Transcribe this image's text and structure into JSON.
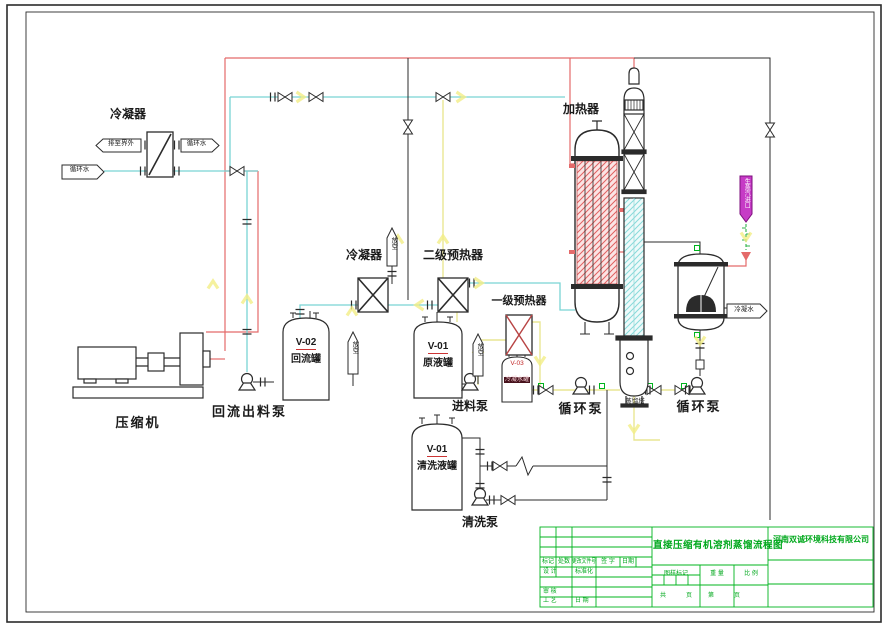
{
  "sheet": {
    "colors": {
      "line_black": "#2b2b2b",
      "pipe_red": "#e46a6a",
      "pipe_cyan": "#79d4d4",
      "pipe_yellow": "#efef9e",
      "cad_green": "#00b41e",
      "highlight_magenta": "#c63bc6"
    }
  },
  "labels": {
    "condenser1": "冷凝器",
    "compressor": "压缩机",
    "reflux_pump": "回流出料泵",
    "v02_tag": "V-02",
    "v02_name": "回流罐",
    "condenser2": "冷凝器",
    "preheater2": "二级预热器",
    "preheater1": "一级预热器",
    "v01_raw_tag": "V-01",
    "v01_raw_name": "原液罐",
    "feed_pump": "进料泵",
    "v03_tag": "V-03",
    "v03_name": "冷凝水罐",
    "v01_wash_tag": "V-01",
    "v01_wash_name": "清洗液罐",
    "wash_pump": "清洗泵",
    "heater": "加热器",
    "column": "蒸馏塔",
    "circ_pump_left": "循环泵",
    "circ_pump_right": "循环泵"
  },
  "stream_tags": {
    "discharge_out": "排至界外",
    "cooling_water_return": "循环水",
    "cooling_water_supply": "循环水",
    "vent_a": "放空",
    "vent_b": "放空",
    "vent_c": "放空",
    "steam_inlet": "生蒸汽进口",
    "condensate_out": "冷凝水"
  },
  "titleblock": {
    "drawing_title": "直接压缩有机溶剂蒸馏流程图",
    "company": "河南双诚环境科技有限公司",
    "mark": "标记",
    "count": "处数",
    "change_doc": "更改文件号",
    "signature": "签 字",
    "date": "日期",
    "design": "设 计",
    "standardize": "标准化",
    "review": "审 核",
    "process": "工 艺",
    "date2": "日 期",
    "drawing_mark": "图样标记",
    "weight": "重 量",
    "scale": "比 例",
    "total": "共",
    "page": "页",
    "sheet_no": "第",
    "page2": "页"
  }
}
